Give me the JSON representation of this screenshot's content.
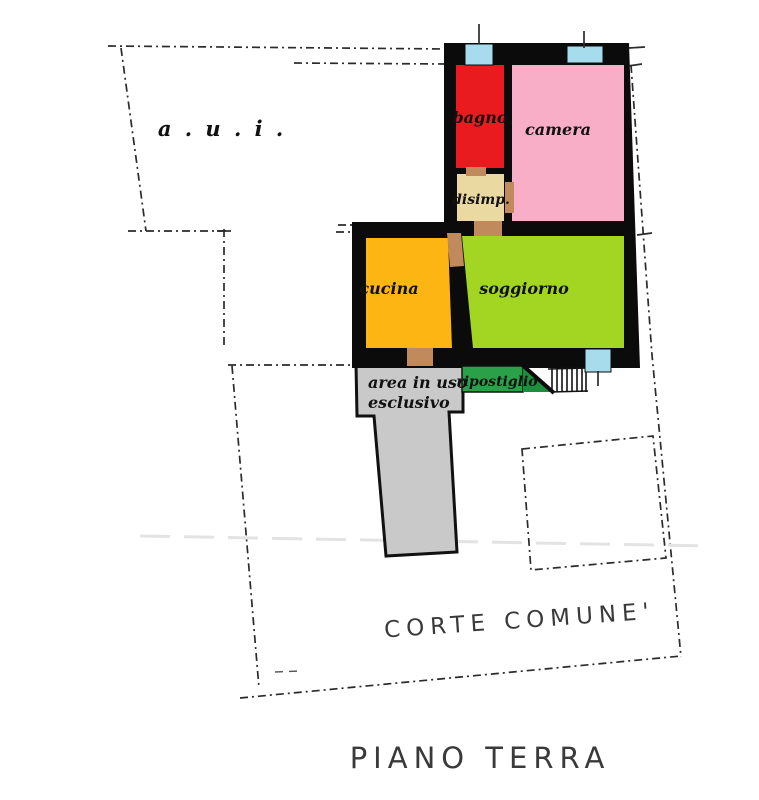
{
  "plan": {
    "title": "PIANO TERRA",
    "court_label": "CORTE COMUNE'",
    "aui_label": "a . u . i .",
    "exclusive_area_label_line1": "area in uso",
    "exclusive_area_label_line2": "esclusivo",
    "rooms": {
      "bagno": {
        "label": "bagno",
        "color": "#ea1b1e"
      },
      "camera": {
        "label": "camera",
        "color": "#f9aec8"
      },
      "disimpegno": {
        "label": "disimp.",
        "color": "#ebd9a2"
      },
      "cucina": {
        "label": "cucina",
        "color": "#fdb513"
      },
      "soggiorno": {
        "label": "soggiorno",
        "color": "#a2d623"
      },
      "ripostiglio": {
        "label": "ripostiglio",
        "color": "#2aa148"
      }
    },
    "colors": {
      "wall": "#0b0b0b",
      "window": "#a6dcec",
      "door": "#c18a5c",
      "exclusive_area": "#c9c9c9",
      "ripostiglio_dark": "#1c8f3e",
      "boundary": "#2b2b2b",
      "hand_text": "#3a3a3a"
    }
  }
}
